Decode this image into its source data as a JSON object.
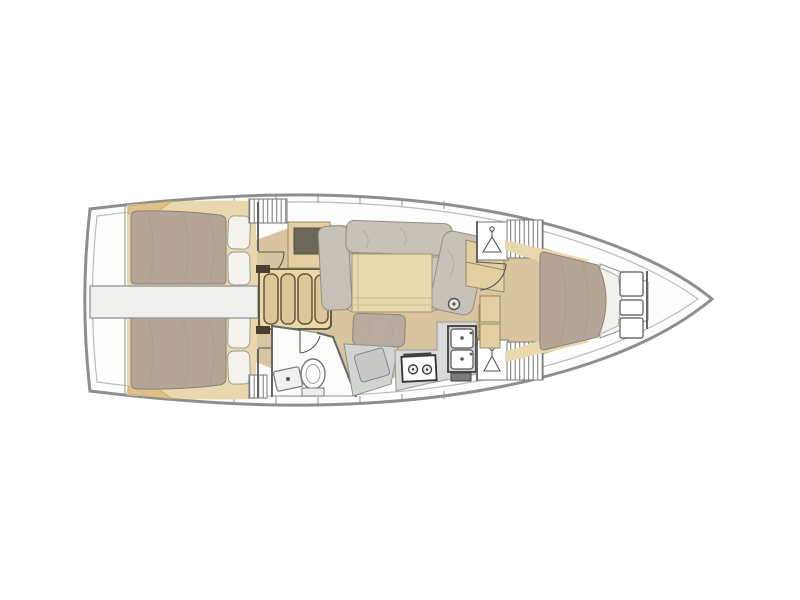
{
  "diagram": {
    "type": "sailboat-interior-floor-plan",
    "view": "top-down",
    "bow_direction": "right",
    "background": "#ffffff"
  },
  "palette": {
    "hull_outline": "#8e8e8e",
    "inner_liner_line": "#bcbcbc",
    "deck_white": "#fdfdfd",
    "floor_wood": "#d8c49e",
    "trim_wood": "#e9d8ae",
    "cabinet_wood": "#e3cfa2",
    "corner_wedge_wood": "#dfc289",
    "step_wood": "#ddc79a",
    "step_outline": "#6b5436",
    "mattress_taupe": "#b4a597",
    "pillow_white": "#f4f3ee",
    "sofa_gray": "#c7c1b7",
    "seat_base_gray": "#cbc6bd",
    "counter_gray": "#d9dbd9",
    "nav_desk_gray": "#d2d4d2",
    "fixture_white": "#fbfbfa",
    "dark_cabinet_inset": "#6e6657",
    "wall_line": "#666666",
    "appliance_outline": "#333333"
  },
  "features": {
    "stern": {
      "swim_platform": "transom-platform"
    },
    "aft_cabins": [
      {
        "id": "aft-cabin-port",
        "berth": "double",
        "pillow_count": 2
      },
      {
        "id": "aft-cabin-starboard",
        "berth": "double",
        "pillow_count": 2
      }
    ],
    "engine_compartment": {
      "location": "centerline-between-aft-cabins"
    },
    "companionway": {
      "step_count": 4
    },
    "saloon": {
      "sofa": "L-shaped-settee",
      "table": "rectangular-dining-table",
      "mast_post": true,
      "opposite_settee": "two-seat-bench"
    },
    "head": {
      "toilet": true,
      "sink": true,
      "shower": true
    },
    "nav_station": {
      "chart_table": true,
      "seat": true
    },
    "galley": {
      "burner_count": 2,
      "sink_basin_count": 2,
      "refrigerator": true
    },
    "wardrobes": {
      "hanging_locker_count": 2
    },
    "forward_cabin": {
      "berth": "island-double",
      "shelf_count": 3
    },
    "bow": {
      "anchor_locker": true
    },
    "hatched_storage_locker_count": 4,
    "door_count": 4
  }
}
